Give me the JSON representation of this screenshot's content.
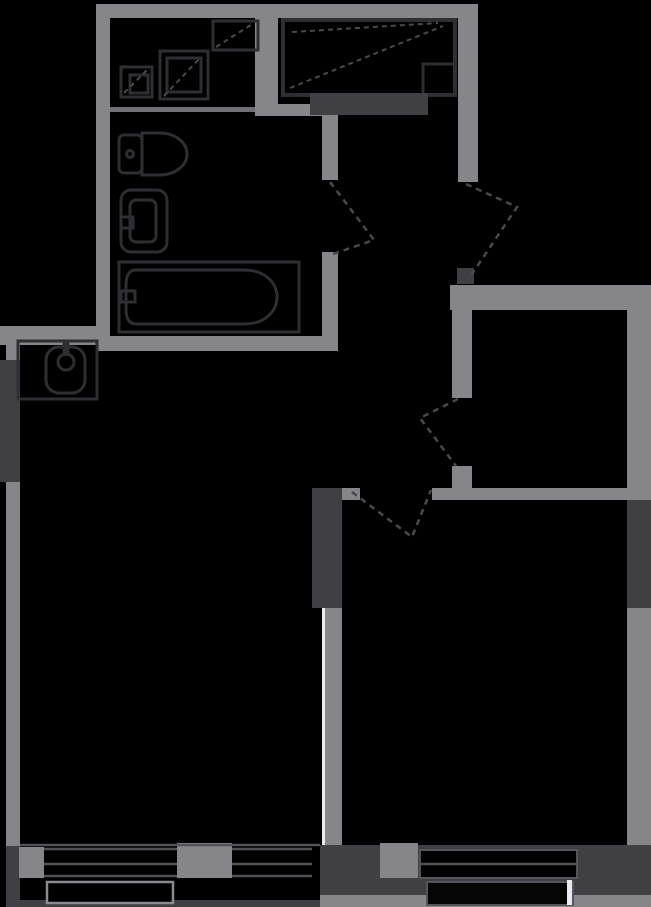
{
  "plan": {
    "kind": "apartment-floor-plan",
    "theme": "dark",
    "width_px": 651,
    "height_px": 907
  },
  "colors": {
    "background": "#000000",
    "wall": "#85858a",
    "wall_dark": "#3f3f44",
    "wall_thin": "#6f6f74",
    "fixture_outline": "#2e2e33",
    "dashed_line": "#4a4a4e",
    "glazing": "#e9e9ee",
    "window_line": "#515156",
    "railing": "#8a8a8f",
    "balcony_strip": "#85858a"
  },
  "fixtures": [
    {
      "name": "kitchen-sink-cabinet"
    },
    {
      "name": "kitchen-stove"
    },
    {
      "name": "kitchen-wall-cabinet"
    },
    {
      "name": "wardrobe"
    },
    {
      "name": "entry-dresser"
    },
    {
      "name": "toilet"
    },
    {
      "name": "washbasin"
    },
    {
      "name": "bathtub"
    },
    {
      "name": "utility-sink"
    }
  ],
  "doors": [
    {
      "name": "entry-door"
    },
    {
      "name": "bathroom-door"
    },
    {
      "name": "bedroom-door"
    },
    {
      "name": "living-room-door"
    }
  ],
  "windows": [
    {
      "name": "living-room-window-left"
    },
    {
      "name": "living-room-window-right"
    },
    {
      "name": "bedroom-window"
    },
    {
      "name": "balcony-railing-left"
    },
    {
      "name": "balcony-railing-right"
    },
    {
      "name": "glazed-partition"
    }
  ]
}
